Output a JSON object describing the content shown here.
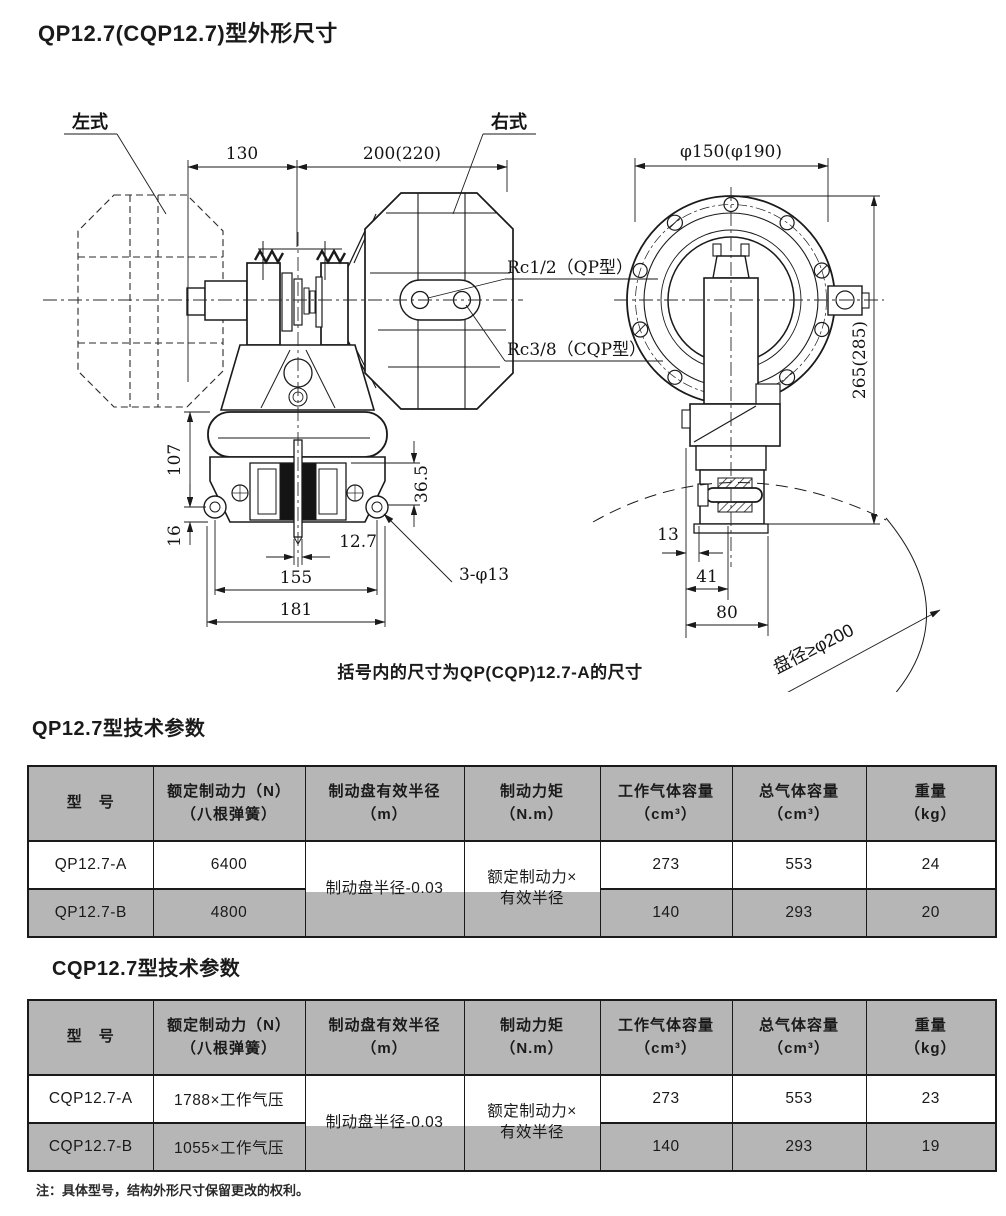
{
  "page": {
    "title": "QP12.7(CQP12.7)型外形尺寸",
    "caption": "括号内的尺寸为QP(CQP)12.7-A的尺寸",
    "note": "注：具体型号，结构外形尺寸保留更改的权利。",
    "colors": {
      "table_gray": "#b6b6b6",
      "line_color": "#1a1a1a",
      "background": "#ffffff"
    }
  },
  "drawing": {
    "front_view": {
      "label_left_type": "左式",
      "label_right_type": "右式",
      "dim_130": "130",
      "dim_200": "200(220)",
      "dim_107": "107",
      "dim_16": "16",
      "dim_36_5": "36.5",
      "dim_12_7": "12.7",
      "dim_155": "155",
      "dim_181": "181",
      "dim_holes": "3-φ13",
      "port_qp": "Rc1/2（QP型）",
      "port_cqp": "Rc3/8（CQP型）"
    },
    "side_view": {
      "dim_flange": "φ150(φ190)",
      "dim_265": "265(285)",
      "dim_13": "13",
      "dim_41": "41",
      "dim_80": "80",
      "disc_note": "盘径≥φ200"
    }
  },
  "table_qp": {
    "title": "QP12.7型技术参数",
    "headers": [
      "型　号",
      "额定制动力（N）\n（八根弹簧）",
      "制动盘有效半径\n（m）",
      "制动力矩\n（N.m）",
      "工作气体容量\n（cm³）",
      "总气体容量\n（cm³）",
      "重量\n（kg）"
    ],
    "merged": {
      "radius": "制动盘半径-0.03",
      "torque": "额定制动力×\n有效半径"
    },
    "rows": [
      {
        "model": "QP12.7-A",
        "force": "6400",
        "work_vol": "273",
        "total_vol": "553",
        "weight": "24"
      },
      {
        "model": "QP12.7-B",
        "force": "4800",
        "work_vol": "140",
        "total_vol": "293",
        "weight": "20"
      }
    ]
  },
  "table_cqp": {
    "title": "CQP12.7型技术参数",
    "headers": [
      "型　号",
      "额定制动力（N）\n（八根弹簧）",
      "制动盘有效半径\n（m）",
      "制动力矩\n（N.m）",
      "工作气体容量\n（cm³）",
      "总气体容量\n（cm³）",
      "重量\n（kg）"
    ],
    "merged": {
      "radius": "制动盘半径-0.03",
      "torque": "额定制动力×\n有效半径"
    },
    "rows": [
      {
        "model": "CQP12.7-A",
        "force": "1788×工作气压",
        "work_vol": "273",
        "total_vol": "553",
        "weight": "23"
      },
      {
        "model": "CQP12.7-B",
        "force": "1055×工作气压",
        "work_vol": "140",
        "total_vol": "293",
        "weight": "19"
      }
    ]
  }
}
